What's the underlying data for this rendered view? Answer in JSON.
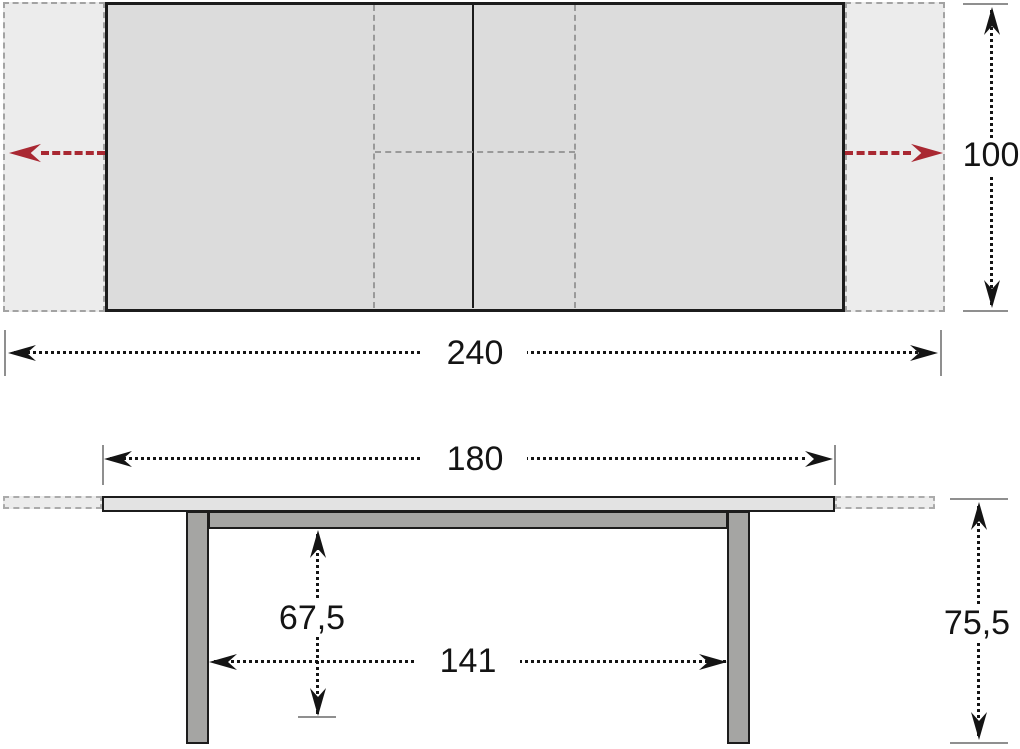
{
  "diagram": {
    "subject": "extendable-table-dimension-drawing",
    "labels": {
      "top_width": "240",
      "top_depth": "100",
      "side_length": "180",
      "underframe_clearance": "67,5",
      "leg_span": "141",
      "total_height": "75,5"
    },
    "colors": {
      "tabletop_fill": "#dcdcdc",
      "extension_leaf_fill": "#ececec",
      "frame_fill": "#a5a5a3",
      "outline": "#1c1c1c",
      "dashed_gray": "#9a9a9a",
      "dimension_line": "#141414",
      "tick_gray": "#8f8f8f",
      "extend_arrow_red": "#a92832"
    }
  }
}
